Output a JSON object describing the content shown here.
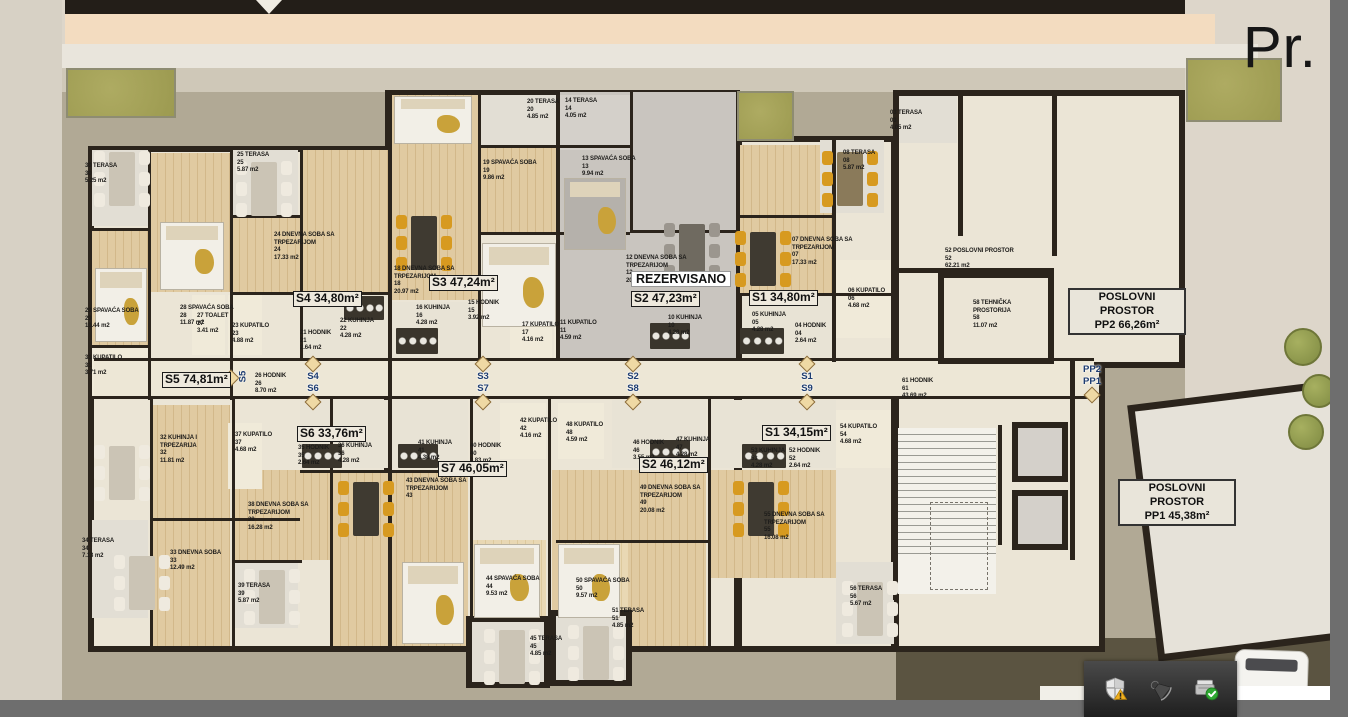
{
  "viewer": {
    "floor_label": "Pr."
  },
  "tray": {
    "icons": [
      {
        "name": "security-shield-warning"
      },
      {
        "name": "audio-speaker"
      },
      {
        "name": "printer-ready"
      }
    ]
  },
  "plan": {
    "reserved_label": "REZERVISANO",
    "rooms": [
      {
        "num": "30",
        "name": "30 TERASA",
        "area": "5.25 m2",
        "x": 85,
        "y": 163
      },
      {
        "num": "28",
        "name": "28 SPAVAĆA SOBA",
        "area": "11.87 m2",
        "x": 180,
        "y": 305
      },
      {
        "num": "25",
        "name": "25 TERASA",
        "area": "5.87 m2",
        "x": 237,
        "y": 152
      },
      {
        "num": "24",
        "name": "24 DNEVNA SOBA SA TRPEZARIJOM",
        "area": "17.33 m2",
        "x": 274,
        "y": 232
      },
      {
        "num": "29",
        "name": "29 SPAVAĆA SOBA",
        "area": "10.44 m2",
        "x": 85,
        "y": 308
      },
      {
        "num": "31",
        "name": "31 KUPATILO",
        "area": "3.71 m2",
        "x": 85,
        "y": 355
      },
      {
        "num": "27",
        "name": "27 TOALET",
        "area": "3.41 m2",
        "x": 197,
        "y": 313
      },
      {
        "num": "23",
        "name": "23 KUPATILO",
        "area": "4.88 m2",
        "x": 232,
        "y": 323
      },
      {
        "num": "21",
        "name": "21 HODNIK",
        "area": "2.64 m2",
        "x": 300,
        "y": 330
      },
      {
        "num": "22",
        "name": "22 KUHINJA",
        "area": "4.28 m2",
        "x": 340,
        "y": 318
      },
      {
        "num": "26",
        "name": "26 HODNIK",
        "area": "8.70 m2",
        "x": 255,
        "y": 373
      },
      {
        "num": "20",
        "name": "20 TERASA",
        "area": "4.85 m2",
        "x": 527,
        "y": 99
      },
      {
        "num": "19",
        "name": "19 SPAVAĆA SOBA",
        "area": "9.86 m2",
        "x": 483,
        "y": 160
      },
      {
        "num": "18",
        "name": "18 DNEVNA SOBA SA TRPEZARIJOM",
        "area": "20.97 m2",
        "x": 394,
        "y": 266
      },
      {
        "num": "16",
        "name": "16 KUHINJA",
        "area": "4.28 m2",
        "x": 416,
        "y": 305
      },
      {
        "num": "15",
        "name": "15 HODNIK",
        "area": "3.92 m2",
        "x": 468,
        "y": 300
      },
      {
        "num": "17",
        "name": "17 KUPATILO",
        "area": "4.16 m2",
        "x": 522,
        "y": 322
      },
      {
        "num": "14",
        "name": "14 TERASA",
        "area": "4.05 m2",
        "x": 565,
        "y": 98
      },
      {
        "num": "13",
        "name": "13 SPAVAĆA SOBA",
        "area": "9.94 m2",
        "x": 582,
        "y": 156
      },
      {
        "num": "12",
        "name": "12 DNEVNA SOBA SA TRPEZARIJOM",
        "area": "20.97 m2",
        "x": 626,
        "y": 255
      },
      {
        "num": "11",
        "name": "11 KUPATILO",
        "area": "4.59 m2",
        "x": 560,
        "y": 320
      },
      {
        "num": "10",
        "name": "10 KUHINJA",
        "area": "4.28 m2",
        "x": 668,
        "y": 315
      },
      {
        "num": "07",
        "name": "07 DNEVNA SOBA SA TRPEZARIJOM",
        "area": "17.33 m2",
        "x": 792,
        "y": 237
      },
      {
        "num": "05",
        "name": "05 KUHINJA",
        "area": "4.28 m2",
        "x": 752,
        "y": 312
      },
      {
        "num": "04",
        "name": "04 HODNIK",
        "area": "2.64 m2",
        "x": 795,
        "y": 323
      },
      {
        "num": "06",
        "name": "06 KUPATILO",
        "area": "4.68 m2",
        "x": 848,
        "y": 288
      },
      {
        "num": "08",
        "name": "08 TERASA",
        "area": "5.87 m2",
        "x": 843,
        "y": 150
      },
      {
        "num": "03",
        "name": "03 TERASA",
        "area": "4.05 m2",
        "x": 890,
        "y": 110
      },
      {
        "num": "52p",
        "name": "52 POSLOVNI PROSTOR",
        "area": "62.21 m2",
        "x": 945,
        "y": 248
      },
      {
        "num": "58",
        "name": "58 TEHNIČKA PROSTORIJA",
        "area": "11.07 m2",
        "x": 973,
        "y": 300
      },
      {
        "num": "61",
        "name": "61 HODNIK",
        "area": "43.69 m2",
        "x": 902,
        "y": 378
      },
      {
        "num": "32",
        "name": "32 KUHINJA I TRPEZARIJA",
        "area": "11.81 m2",
        "x": 160,
        "y": 435
      },
      {
        "num": "37",
        "name": "37 KUPATILO",
        "area": "4.68 m2",
        "x": 235,
        "y": 432
      },
      {
        "num": "35",
        "name": "35 HODNIK",
        "area": "2.64 m2",
        "x": 298,
        "y": 445
      },
      {
        "num": "36",
        "name": "36 KUHINJA",
        "area": "4.28 m2",
        "x": 338,
        "y": 443
      },
      {
        "num": "34",
        "name": "34 TERASA",
        "area": "7.13 m2",
        "x": 82,
        "y": 538
      },
      {
        "num": "33",
        "name": "33 DNEVNA SOBA",
        "area": "12.49 m2",
        "x": 170,
        "y": 550
      },
      {
        "num": "38",
        "name": "38 DNEVNA SOBA SA TRPEZARIJOM",
        "area": "16.28 m2",
        "x": 248,
        "y": 502
      },
      {
        "num": "39",
        "name": "39 TERASA",
        "area": "5.87 m2",
        "x": 238,
        "y": 583
      },
      {
        "num": "41",
        "name": "41 KUHINJA",
        "area": "4.38 m2",
        "x": 418,
        "y": 440
      },
      {
        "num": "40",
        "name": "40 HODNIK",
        "area": "3.83 m2",
        "x": 470,
        "y": 443
      },
      {
        "num": "43",
        "name": "43 DNEVNA SOBA SA TRPEZARIJOM",
        "area": "",
        "x": 406,
        "y": 478
      },
      {
        "num": "42",
        "name": "42 KUPATILO",
        "area": "4.16 m2",
        "x": 520,
        "y": 418
      },
      {
        "num": "48",
        "name": "48 KUPATILO",
        "area": "4.59 m2",
        "x": 566,
        "y": 422
      },
      {
        "num": "46",
        "name": "46 HODNIK",
        "area": "3.55 m2",
        "x": 633,
        "y": 440
      },
      {
        "num": "47",
        "name": "47 KUHINJA",
        "area": "4.28 m2",
        "x": 676,
        "y": 437
      },
      {
        "num": "49",
        "name": "49 DNEVNA SOBA SA TRPEZARIJOM",
        "area": "20.08 m2",
        "x": 640,
        "y": 485
      },
      {
        "num": "44",
        "name": "44 SPAVAĆA SOBA",
        "area": "9.53 m2",
        "x": 486,
        "y": 576
      },
      {
        "num": "45",
        "name": "45 TERASA",
        "area": "4.85 m2",
        "x": 530,
        "y": 636
      },
      {
        "num": "50",
        "name": "50 SPAVAĆA SOBA",
        "area": "9.57 m2",
        "x": 576,
        "y": 578
      },
      {
        "num": "51",
        "name": "51 TERASA",
        "area": "4.85 m2",
        "x": 612,
        "y": 608
      },
      {
        "num": "53",
        "name": "53 KUHINJA",
        "area": "4.28 m2",
        "x": 751,
        "y": 448
      },
      {
        "num": "52",
        "name": "52 HODNIK",
        "area": "2.64 m2",
        "x": 789,
        "y": 448
      },
      {
        "num": "54",
        "name": "54 KUPATILO",
        "area": "4.68 m2",
        "x": 840,
        "y": 424
      },
      {
        "num": "55",
        "name": "55 DNEVNA SOBA SA TRPEZARIJOM",
        "area": "16.08 m2",
        "x": 764,
        "y": 512
      },
      {
        "num": "56",
        "name": "56 TERASA",
        "area": "5.67 m2",
        "x": 850,
        "y": 586
      }
    ],
    "unit_tags": [
      {
        "text": "S5 74,81m²",
        "x": 162,
        "y": 372
      },
      {
        "text": "S4 34,80m²",
        "x": 293,
        "y": 291
      },
      {
        "text": "S3 47,24m²",
        "x": 429,
        "y": 275
      },
      {
        "text": "S2 47,23m²",
        "x": 631,
        "y": 291
      },
      {
        "text": "S1 34,80m²",
        "x": 749,
        "y": 290
      },
      {
        "text": "S6 33,76m²",
        "x": 297,
        "y": 426
      },
      {
        "text": "S7 46,05m²",
        "x": 438,
        "y": 461
      },
      {
        "text": "S2 46,12m²",
        "x": 639,
        "y": 457
      },
      {
        "text": "S1 34,15m²",
        "x": 762,
        "y": 425
      }
    ],
    "big_tags": [
      {
        "line1": "POSLOVNI PROSTOR",
        "line2": "PP2 66,26m²",
        "x": 1006,
        "y": 288,
        "w": 106
      },
      {
        "line1": "POSLOVNI PROSTOR",
        "line2": "PP1 45,38m²",
        "x": 1056,
        "y": 479,
        "w": 106
      }
    ],
    "markers": [
      {
        "up": "S4",
        "side": "S5",
        "down": "S6",
        "x": 251,
        "y": 357
      },
      {
        "up": "S3",
        "down": "S7",
        "x": 421,
        "y": 357
      },
      {
        "up": "S2",
        "down": "S8",
        "x": 571,
        "y": 357
      },
      {
        "up": "S1",
        "down": "S9",
        "x": 745,
        "y": 357
      },
      {
        "up": "PP2",
        "down": "PP1",
        "x": 1030,
        "y": 364,
        "no_up_arrow": true
      }
    ]
  }
}
